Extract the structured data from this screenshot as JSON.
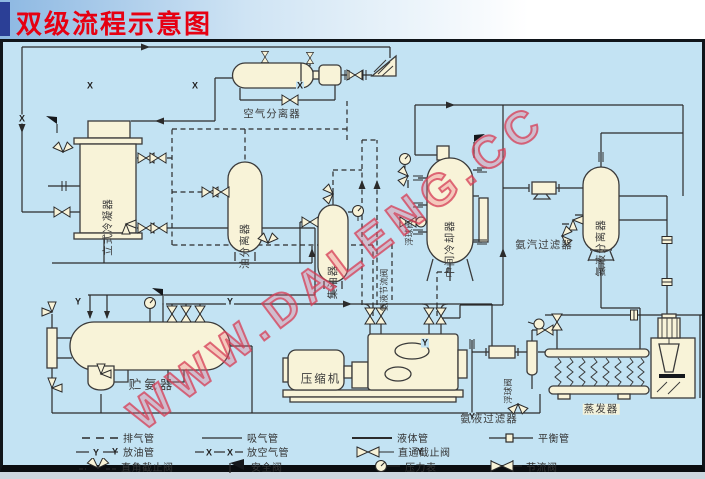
{
  "title": "双级流程示意图",
  "watermark": "WWW.DALENG.CC",
  "pipe_marks": {
    "air": "X",
    "oil": "Y"
  },
  "components": {
    "vertical_condenser": "立式冷凝器",
    "oil_separator": "油分离器",
    "air_separator": "空气分离器",
    "oil_collector": "集油器",
    "intermediate_cooler": "中间冷却器",
    "ammonia_receiver": "贮氨器",
    "compressor": "压缩机",
    "ammonia_liquid_separator": "氨液分离器",
    "evaporator": "蒸发器",
    "ammonia_vapor_filter": "氨汽过滤器",
    "ammonia_liquid_filter": "氨液过滤器",
    "float_valve_upper": "浮球阀",
    "float_valve_lower": "浮球阀",
    "ammonia_throttle_valve": "氨液节流阀"
  },
  "legend": {
    "items": [
      {
        "symbol": "dashed-line",
        "label": "排气管"
      },
      {
        "symbol": "solid-line",
        "label": "吸气管"
      },
      {
        "symbol": "liquid-line",
        "label": "液体管"
      },
      {
        "symbol": "balance-line",
        "label": "平衡管"
      },
      {
        "symbol": "oil-drain-line",
        "label": "放油管"
      },
      {
        "symbol": "air-release-line",
        "label": "放空气管"
      },
      {
        "symbol": "straight-stop-valve",
        "label": "直通截止阀"
      },
      {
        "symbol": "angle-stop-valve",
        "label": "直角截止阀"
      },
      {
        "symbol": "safety-valve",
        "label": "安全阀"
      },
      {
        "symbol": "pressure-gauge",
        "label": "压力表"
      },
      {
        "symbol": "throttle-valve",
        "label": "节流阀"
      }
    ]
  },
  "colors": {
    "title": "#e60012",
    "panel_bg": "#c3e3f3",
    "vessel_fill": "#f8f3d8",
    "line": "#2b2b2b",
    "watermark": "#d8536e"
  }
}
